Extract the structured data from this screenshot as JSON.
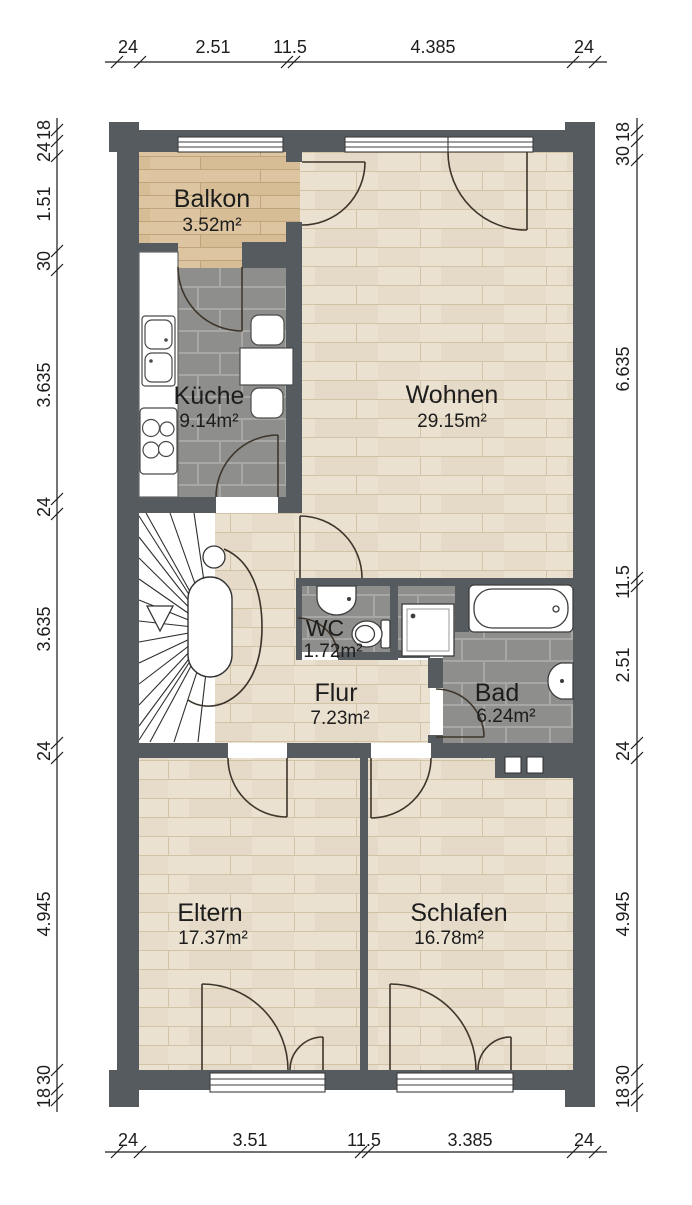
{
  "rooms": {
    "balkon": {
      "name": "Balkon",
      "area": "3.52m²"
    },
    "kueche": {
      "name": "Küche",
      "area": "9.14m²"
    },
    "wohnen": {
      "name": "Wohnen",
      "area": "29.15m²"
    },
    "wc": {
      "name": "WC",
      "area": "1.72m²"
    },
    "flur": {
      "name": "Flur",
      "area": "7.23m²"
    },
    "bad": {
      "name": "Bad",
      "area": "6.24m²"
    },
    "eltern": {
      "name": "Eltern",
      "area": "17.37m²"
    },
    "schlafen": {
      "name": "Schlafen",
      "area": "16.78m²"
    }
  },
  "dimensions": {
    "top": [
      "24",
      "2.51",
      "11.5",
      "4.385",
      "24"
    ],
    "bottom": [
      "24",
      "3.51",
      "11.5",
      "3.385",
      "24"
    ],
    "left": [
      "18",
      "24",
      "1.51",
      "30",
      "3.635",
      "24",
      "3.635",
      "24",
      "4.945",
      "30",
      "18"
    ],
    "right": [
      "18",
      "30",
      "6.635",
      "11.5",
      "2.51",
      "24",
      "4.945",
      "30",
      "18"
    ]
  },
  "colors": {
    "wall": "#565b60",
    "wood": "#eae1d0",
    "wood_line": "#cbb895",
    "balcony_wood": "#dcc5a0",
    "balcony_line": "#bb9f75",
    "tile": "#8e8e8c",
    "tile_line": "#a7a7a5",
    "door": "#3e362b",
    "dimension": "#1c1c1c"
  }
}
